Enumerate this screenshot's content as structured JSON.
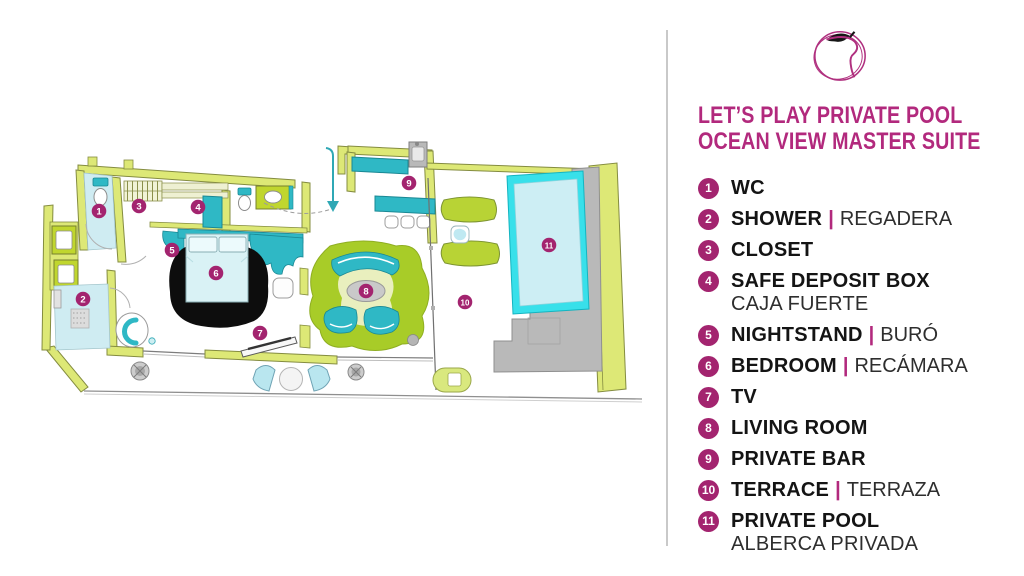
{
  "title": {
    "line1": "LET’S PLAY PRIVATE POOL",
    "line2": "OCEAN VIEW MASTER SUITE"
  },
  "logo": {
    "name": "apple-scribble-logo"
  },
  "colors": {
    "accent_magenta": "#b2297d",
    "marker_magenta": "#a3246f",
    "wall_lime": "#dde876",
    "wall_outline": "#848c40",
    "bright_lime": "#c0d62e",
    "living_green": "#a8cc28",
    "teal": "#2fb8c5",
    "pool_edge_cyan": "#38e0ea",
    "water_blue": "#cdeef4",
    "deck_gray": "#b9b9b9",
    "rug_black": "#0d0d0d"
  },
  "legend": {
    "separator": "|",
    "items": [
      {
        "num": "1",
        "en": "WC"
      },
      {
        "num": "2",
        "en": "SHOWER",
        "es": "REGADERA"
      },
      {
        "num": "3",
        "en": "CLOSET"
      },
      {
        "num": "4",
        "en": "SAFE DEPOSIT BOX",
        "line2": "CAJA FUERTE"
      },
      {
        "num": "5",
        "en": "NIGHTSTAND",
        "es": "BURÓ"
      },
      {
        "num": "6",
        "en": "BEDROOM",
        "es": "RECÁMARA"
      },
      {
        "num": "7",
        "en": "TV"
      },
      {
        "num": "8",
        "en": "LIVING ROOM"
      },
      {
        "num": "9",
        "en": "PRIVATE BAR"
      },
      {
        "num": "10",
        "en": "TERRACE",
        "es": "TERRAZA"
      },
      {
        "num": "11",
        "en": "PRIVATE POOL",
        "line2": "ALBERCA PRIVADA"
      }
    ]
  },
  "plan": {
    "markers": [
      {
        "num": "1",
        "x": 99,
        "y": 211
      },
      {
        "num": "2",
        "x": 83,
        "y": 299
      },
      {
        "num": "3",
        "x": 139,
        "y": 206
      },
      {
        "num": "4",
        "x": 198,
        "y": 207
      },
      {
        "num": "5",
        "x": 172,
        "y": 250
      },
      {
        "num": "6",
        "x": 216,
        "y": 273
      },
      {
        "num": "7",
        "x": 260,
        "y": 333
      },
      {
        "num": "8",
        "x": 366,
        "y": 291
      },
      {
        "num": "9",
        "x": 409,
        "y": 183
      },
      {
        "num": "10",
        "x": 465,
        "y": 302
      },
      {
        "num": "11",
        "x": 549,
        "y": 245
      }
    ]
  }
}
